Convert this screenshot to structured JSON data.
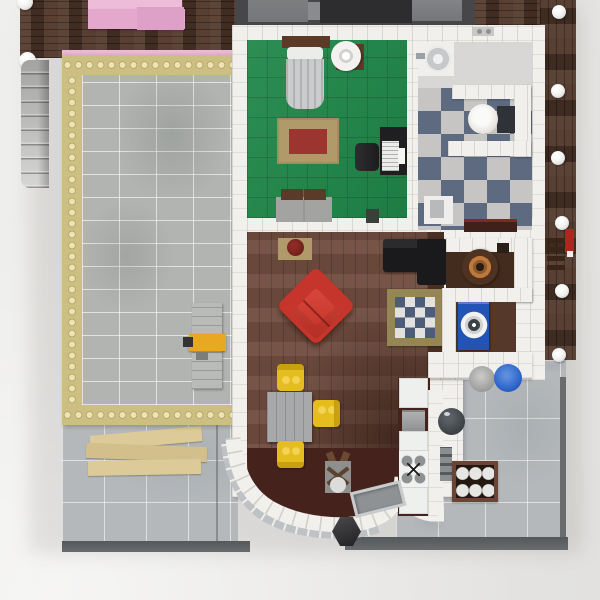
{
  "image": {
    "type": "3d-render",
    "subject": "Top-down aerial view of a LEGO modular house interior floor plan with pool terrace, bedroom, bathroom, living-dining room, kitchen and patios",
    "visible_text": []
  },
  "palette": {
    "bg_light": "#efefed",
    "bg_dark": "#e2e1df",
    "deck_wood": "#53392c",
    "pink": "#e3a8cc",
    "pink_light": "#ecbcd8",
    "pink_deep": "#dda0c6",
    "gold": "#cdbe81",
    "gold_stud": "#eee3b1",
    "gold_shadow": "#b3a268",
    "pool_tile": "#b2b4b2",
    "patio_tile": "#b4b8bb",
    "plate_edge": "#686c6f",
    "stair_light": "#d6d6d4",
    "stair_dark": "#a3a3a1",
    "wall_white": "#f2f0ec",
    "green": "#1f8749",
    "checker_dark": "#5d6a80",
    "checker_light": "#c6c5c3",
    "bath_plain": "#d8d7d5",
    "wood": "#6f4c3e",
    "wood_dark": "#4a2f24",
    "maroon": "#45231c",
    "nook_wood": "#55382a",
    "nook_dark": "#432c1d",
    "red": "#c5352b",
    "yellow": "#e6bd1e",
    "table_gray": "#a7a9ab",
    "rug_tan": "#b09a6a",
    "rug_red": "#9c3530",
    "crug_border": "#968555",
    "crug_blue": "#4d5c78",
    "crug_white": "#e2e1dd",
    "machine_blue": "#2353b5",
    "barrel_blue": "#2a62c8",
    "crate_brown": "#6a4434",
    "crate_dark": "#241812",
    "tan_plank": "#dcca98",
    "roof_dark": "#2d2d2f",
    "roof_mid": "#47474a",
    "roof_light": "#75767a",
    "black": "#1a1a1c",
    "stud_white": "#efefed",
    "table_brown": "#4e3322",
    "table_orange": "#c07838",
    "headboard_brown": "#5b3a28",
    "well_gray": "#41464a",
    "bench_gray": "#b9bbb9",
    "tool_yellow": "#e8a821",
    "red_accent": "#b0251f",
    "glass": "#bfc2c4"
  },
  "scene": {
    "rooms": [
      {
        "name": "bedroom",
        "floor": "green tile",
        "furniture": [
          "bed with brown headboard",
          "ceiling fan on brown table",
          "tan rug with dark-red center",
          "black desk with laptop",
          "desk chair",
          "gray dresser with brown drawers",
          "waste bin"
        ]
      },
      {
        "name": "bathroom",
        "floor": "blue-and-white checkerboard",
        "furniture": [
          "shower head",
          "toilet in white alcove",
          "sink",
          "dark-red bath mat",
          "wall clips"
        ]
      },
      {
        "name": "living-dining-room",
        "floor": "brown wood planks",
        "furniture": [
          "black sofa with chaise",
          "red armchair rotated 45deg",
          "blue-white checkered rug",
          "plant on tan mat",
          "gray dining table",
          "three yellow chairs",
          "coat stand with antlers"
        ]
      },
      {
        "name": "kitchen",
        "floor": "dark maroon",
        "furniture": [
          "white counters",
          "oven",
          "four-burner stove",
          "gray sink tray"
        ]
      },
      {
        "name": "utility-nooks",
        "floor": "dark wood",
        "furniture": [
          "round wood table with orange rim",
          "blue washing machine"
        ]
      },
      {
        "name": "pool-terrace",
        "floor": "light gray tile",
        "furniture": [
          "gold studded frame",
          "gray work bench",
          "yellow tool"
        ]
      },
      {
        "name": "patios",
        "floor": "blue-gray tile",
        "furniture": [
          "stack of tan planks",
          "round well",
          "crate of six bottles",
          "gray barrel",
          "blue barrel",
          "dark hex table"
        ]
      },
      {
        "name": "roof-deck",
        "floor": "dark wood planks",
        "furniture": [
          "pink sectional sofa",
          "white corner studs",
          "gray staircase",
          "red wall fixture"
        ]
      }
    ]
  }
}
